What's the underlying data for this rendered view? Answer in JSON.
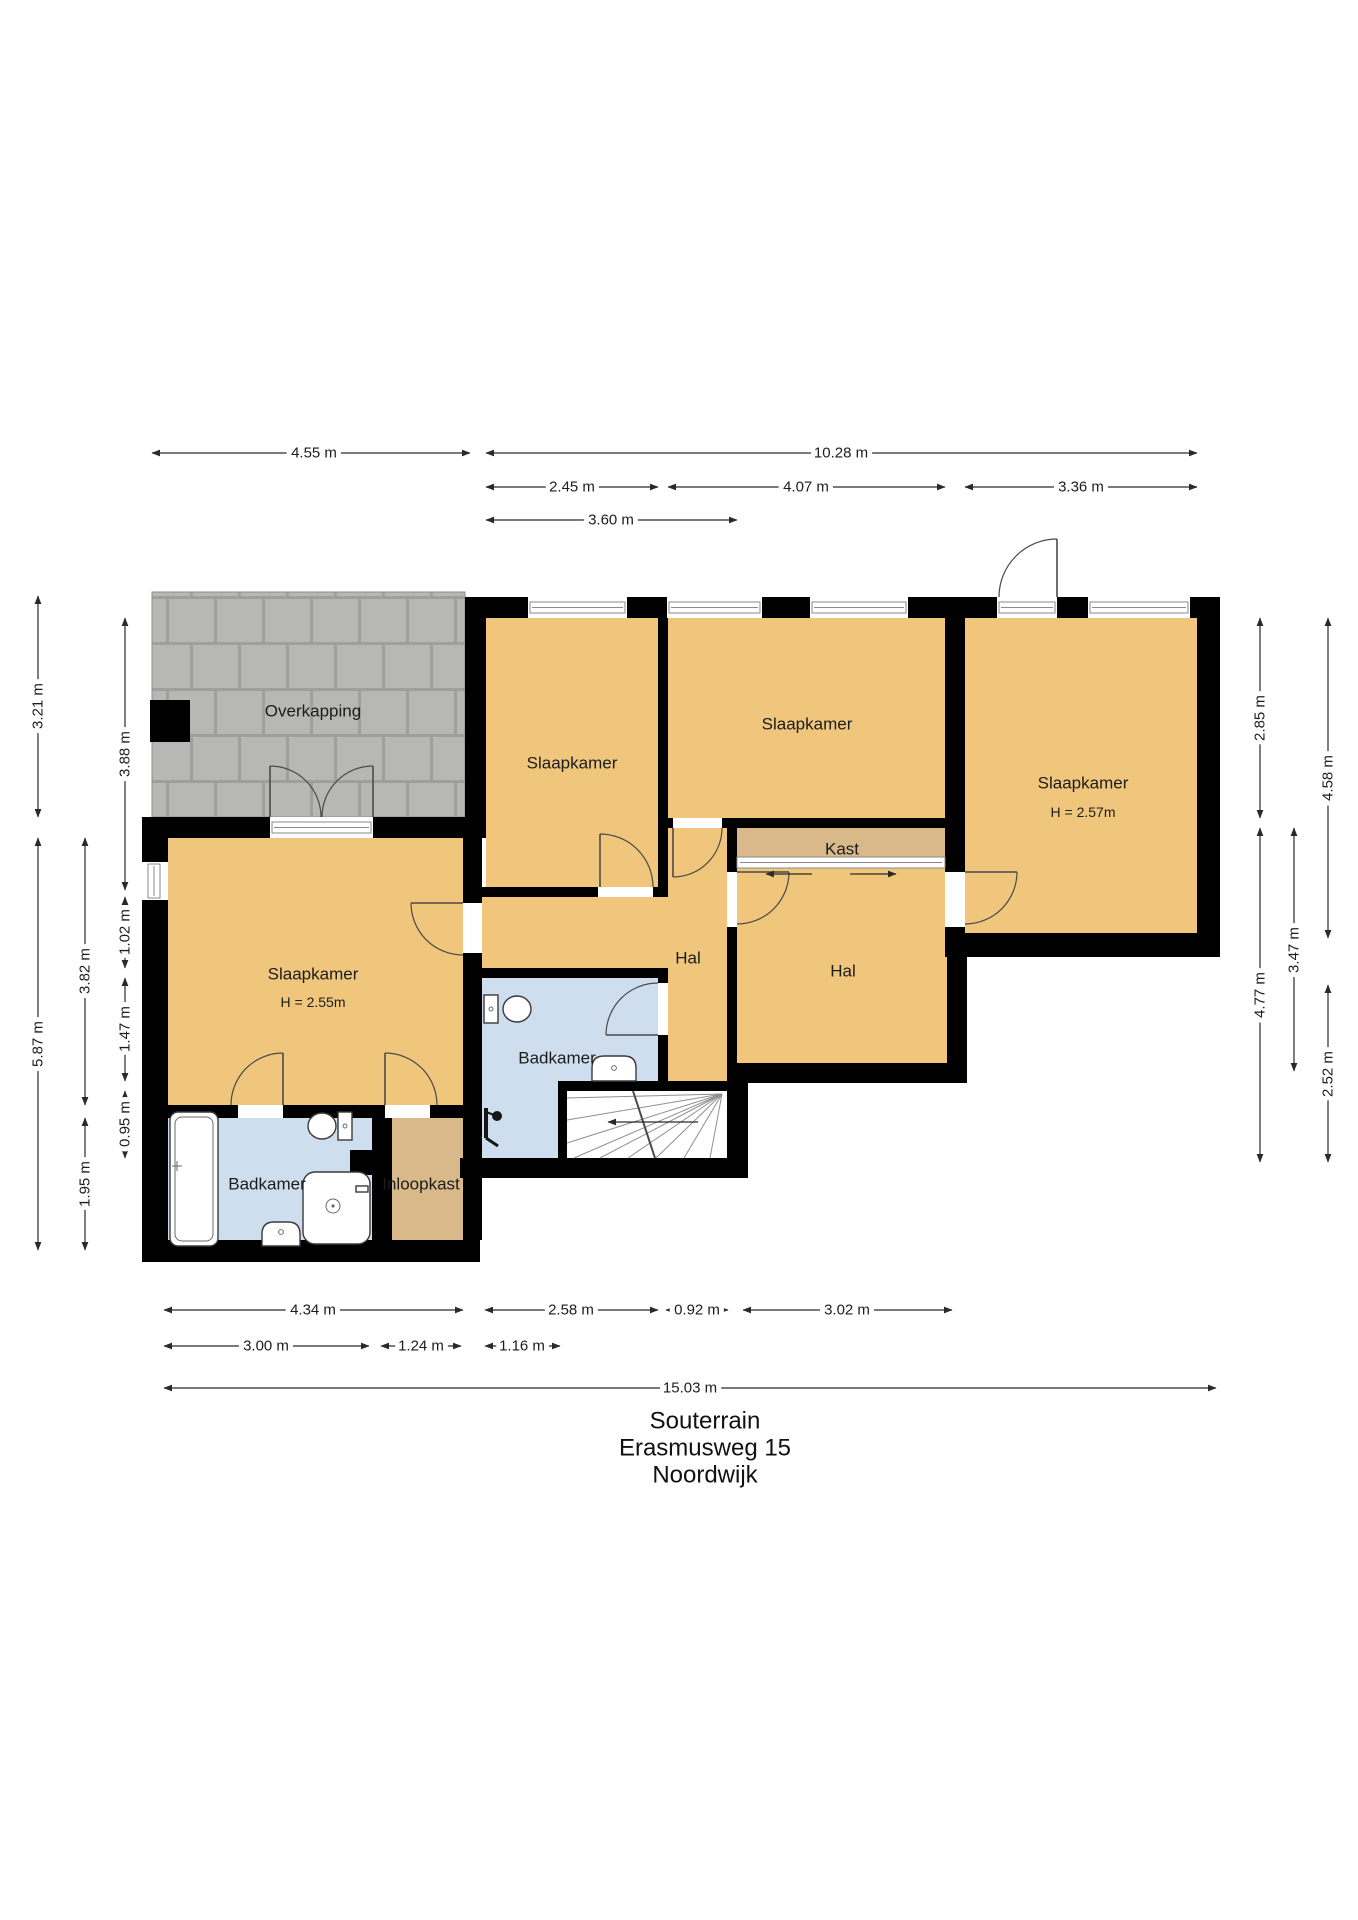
{
  "title": {
    "floor": "Souterrain",
    "address": "Erasmusweg 15",
    "city": "Noordwijk"
  },
  "rooms": {
    "overkapping": "Overkapping",
    "slaapkamer_top_left": "Slaapkamer",
    "slaapkamer_top_middle": "Slaapkamer",
    "slaapkamer_right": "Slaapkamer",
    "slaapkamer_right_height": "H = 2.57m",
    "slaapkamer_large": "Slaapkamer",
    "slaapkamer_large_height": "H = 2.55m",
    "kast": "Kast",
    "hal_middle": "Hal",
    "hal_right": "Hal",
    "badkamer_middle": "Badkamer",
    "badkamer_left": "Badkamer",
    "inloopkast": "Inloopkast"
  },
  "dims": {
    "top": [
      "4.55 m",
      "10.28 m",
      "2.45 m",
      "4.07 m",
      "3.36 m",
      "3.60 m"
    ],
    "left": [
      "3.21 m",
      "5.87 m",
      "3.82 m",
      "1.95 m",
      "3.88 m",
      "1.02 m",
      "1.47 m",
      "0.95 m"
    ],
    "right": [
      "2.85 m",
      "4.77 m",
      "3.47 m",
      "4.58 m",
      "2.52 m"
    ],
    "bottom": [
      "4.34 m",
      "2.58 m",
      "0.92 m",
      "3.02 m",
      "3.00 m",
      "1.24 m",
      "1.16 m",
      "15.03 m"
    ]
  },
  "colors": {
    "wall": "#000000",
    "room_floor": "#efc67c",
    "closet_floor": "#d9b98a",
    "bath_floor": "#cfdeee",
    "paving_stone": "#b7b7b5",
    "paving_joint": "#9f9f9d",
    "stairs": "#ffffff"
  }
}
